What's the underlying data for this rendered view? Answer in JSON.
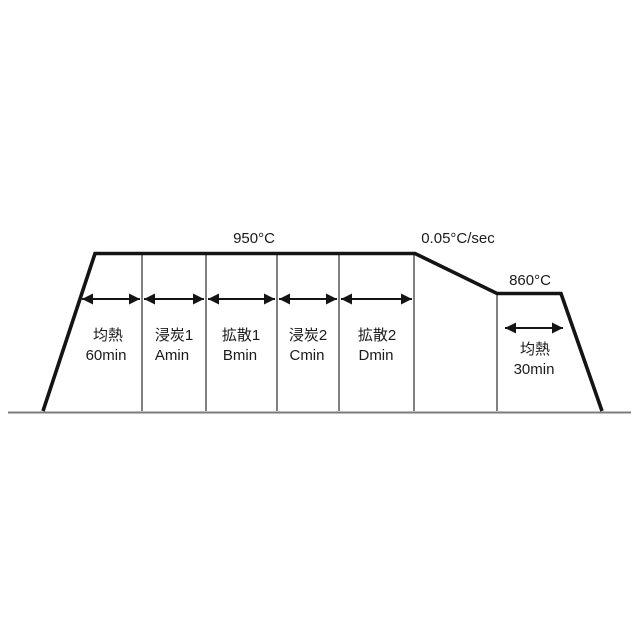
{
  "diagram": {
    "peak_temp_label": "950°C",
    "cooling_rate_label": "0.05°C/sec",
    "hold_temp_label": "860°C",
    "stages": [
      {
        "name": "均熱",
        "duration": "60min"
      },
      {
        "name": "浸炭1",
        "duration": "Amin"
      },
      {
        "name": "拡散1",
        "duration": "Bmin"
      },
      {
        "name": "浸炭2",
        "duration": "Cmin"
      },
      {
        "name": "拡散2",
        "duration": "Dmin"
      }
    ],
    "final_stage": {
      "name": "均熱",
      "duration": "30min"
    }
  }
}
